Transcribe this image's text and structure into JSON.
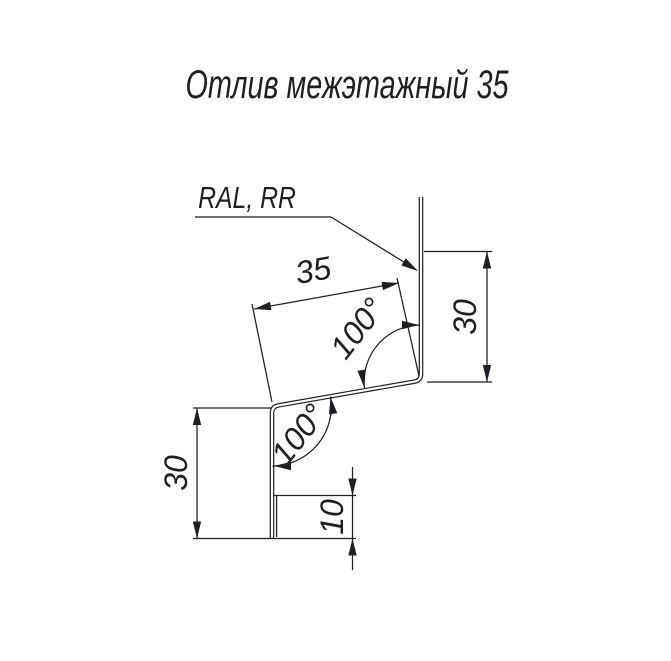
{
  "title": "Отлив межэтажный 35",
  "material_label": "RAL, RR",
  "dims": {
    "slant_width": "35",
    "angle_upper": "100°",
    "angle_lower": "100°",
    "right_flange": "30",
    "left_flange": "30",
    "hem": "10"
  },
  "colors": {
    "ink": "#1d1f23",
    "background": "#ffffff"
  }
}
